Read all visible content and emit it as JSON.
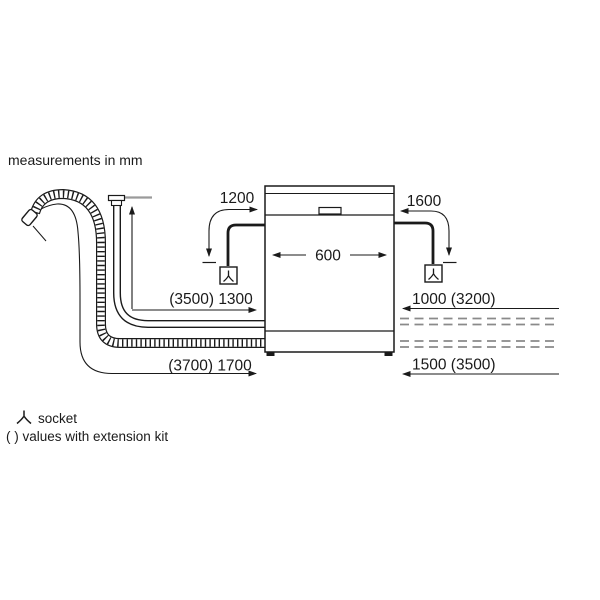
{
  "title": "measurements in mm",
  "labels": {
    "cord_left": "1200",
    "cord_right": "1600",
    "appliance_width": "600",
    "supply_hose_left": "(3500) 1300",
    "drain_hose_left": "(3700) 1700",
    "supply_hose_right": "1000 (3200)",
    "drain_hose_right": "1500 (3500)"
  },
  "legend": {
    "socket_label": "socket",
    "extension_label": "( ) values with extension kit"
  },
  "colors": {
    "line": "#1a1a1a",
    "dashed_hose": "#8a8a8a",
    "tap_level": "#9a9a9a",
    "background": "#ffffff"
  }
}
